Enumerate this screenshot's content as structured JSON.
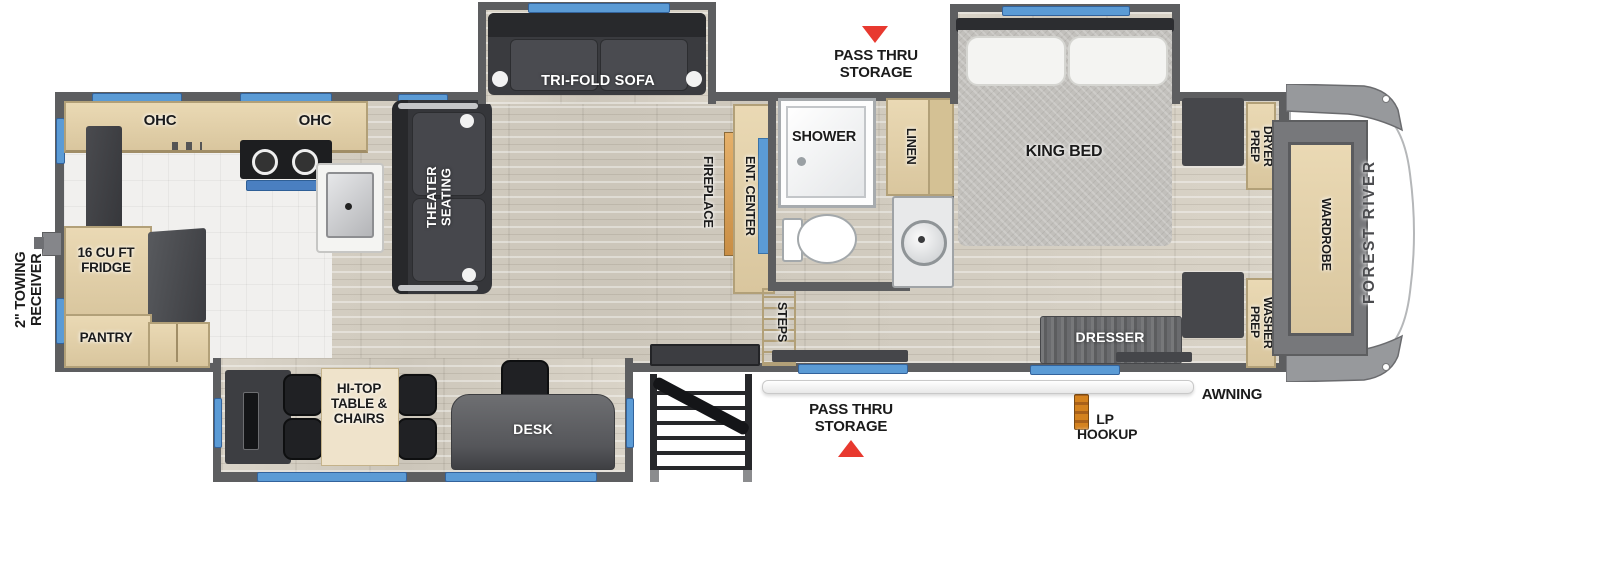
{
  "title": "Fifth wheel RV floor plan",
  "colors": {
    "wall": "#5d5e60",
    "window_accent": "#5b9bd5",
    "marker_red": "#e8392f",
    "cabinet_tan": "#e0d0ab",
    "floor_wood": "#d5cfc3",
    "dark_furniture": "#3a3b3f",
    "lp_orange": "#d4821e",
    "mattress_gray": "#c2c0bc"
  },
  "exterior": {
    "towing_receiver": "2\" TOWING RECEIVER",
    "pass_thru_storage_top": "PASS THRU STORAGE",
    "pass_thru_storage_bottom": "PASS THRU STORAGE",
    "lp_hookup": "LP HOOKUP",
    "awning": "AWNING",
    "brand": "FOREST RIVER"
  },
  "kitchen": {
    "ohc_left": "OHC",
    "ohc_right": "OHC",
    "fridge": "16 CU FT FRIDGE",
    "pantry": "PANTRY"
  },
  "living_room": {
    "tri_fold_sofa": "TRI-FOLD SOFA",
    "theater_seating": "THEATER SEATING",
    "fireplace": "FIREPLACE",
    "ent_center": "ENT. CENTER",
    "steps": "STEPS"
  },
  "bathroom": {
    "shower": "SHOWER",
    "linen": "LINEN"
  },
  "bedroom": {
    "king_bed": "KING BED",
    "dresser": "DRESSER",
    "dryer_prep": "DRYER PREP",
    "washer_prep": "WASHER PREP",
    "wardrobe": "WARDROBE"
  },
  "rear_slide": {
    "hi_top_table": "HI-TOP TABLE & CHAIRS",
    "desk": "DESK"
  }
}
